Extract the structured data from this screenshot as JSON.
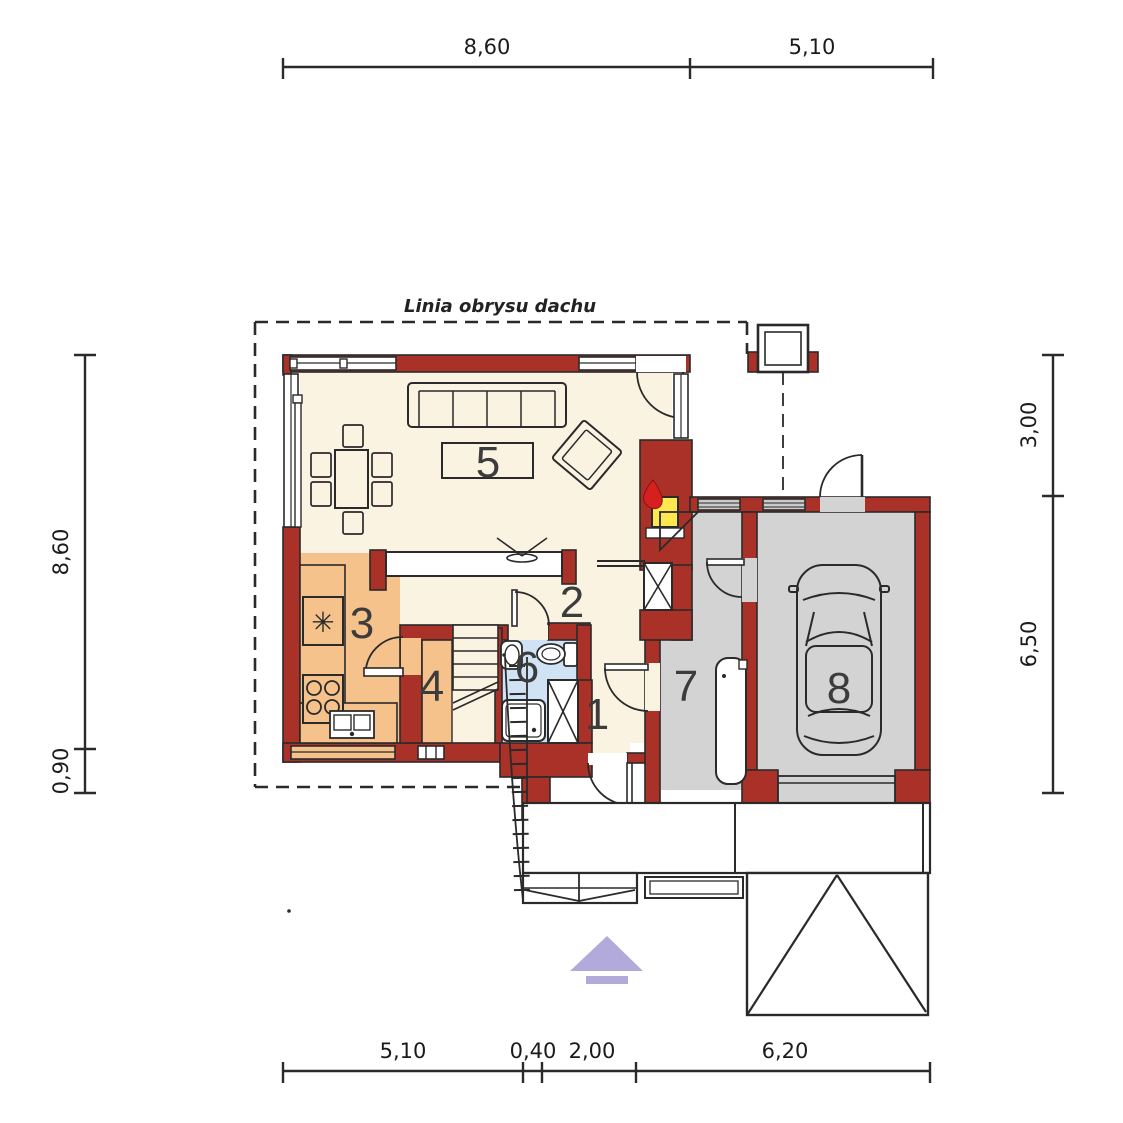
{
  "drawing": {
    "roof_outline_label": "Linia obrysu dachu",
    "room_labels": {
      "r1": "1",
      "r2": "2",
      "r3": "3",
      "r4": "4",
      "r5": "5",
      "r6": "6",
      "r7": "7",
      "r8": "8"
    },
    "dimensions": {
      "top": {
        "d1": "8,60",
        "d2": "5,10"
      },
      "bottom": {
        "d1": "5,10",
        "d2": "0,40",
        "d3": "2,00",
        "d4": "6,20"
      },
      "left": {
        "d1": "8,60",
        "d2": "0,90"
      },
      "right": {
        "d1": "3,00",
        "d2": "6,50"
      }
    },
    "icons": {
      "fridge_glyph": "✳"
    },
    "colors": {
      "wall_red": "#a93128",
      "line": "#2a2a2a",
      "floor_main": "#faf3e2",
      "floor_kitchen": "#f5c28c",
      "floor_bath": "#cfe3f4",
      "floor_garage": "#d3d3d3",
      "window_sill_gray": "#cbcbcb",
      "fireplace_yellow": "#ffe74f",
      "flame_red": "#d61f1f",
      "north_arrow_purple": "#b2aadb"
    }
  }
}
